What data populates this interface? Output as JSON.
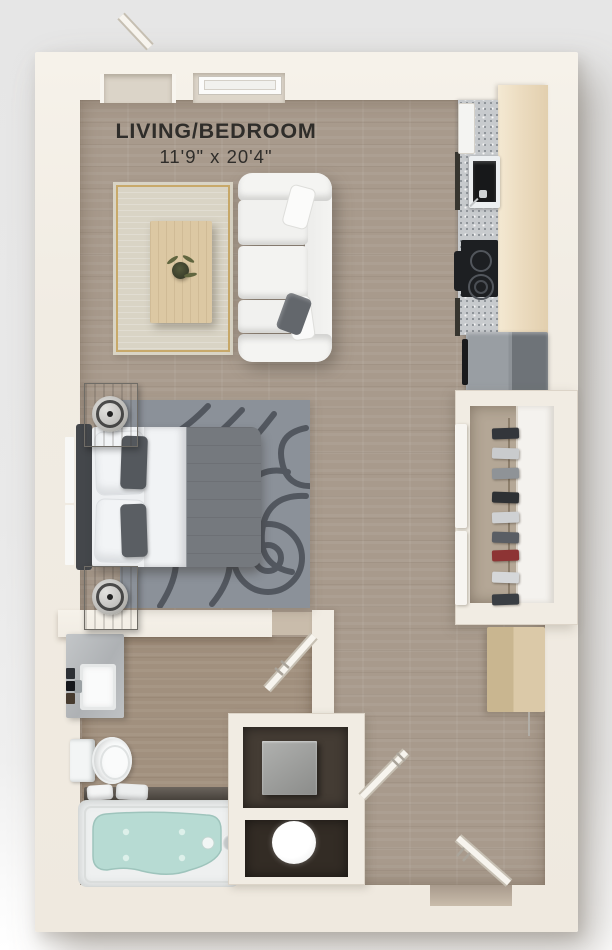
{
  "labels": {
    "room": "LIVING/BEDROOM",
    "dimensions": "11'9\" x 20'4\""
  },
  "palette": {
    "background": "#e9e9e9",
    "wall": "#f1ece3",
    "floor_wood": "#a89a8c",
    "floor_bath": "#a1907e",
    "floor_dark": "#332c25",
    "rug_living": "#d9d4c5",
    "rug_living_border": "#c8a96a",
    "rug_bed": "#8b9199",
    "rug_bed_pattern": "#494e55",
    "sofa_white": "#f4f4f2",
    "bed_duvet": "#75797e",
    "counter_granite": "#c7cacd",
    "cabinet_tan": "#ecdcc0",
    "fridge_gray": "#8d9297",
    "cooktop_black": "#1d1f22",
    "tub_water": "#b7dbd3",
    "wood_light": "#dcc8a3",
    "door_leaf": "#f7f4ee",
    "text": "#2f2d2a"
  },
  "features": {
    "rooms": [
      "living-bedroom",
      "kitchen",
      "closet",
      "bathroom",
      "utility-closets",
      "entry"
    ],
    "fixtures": [
      "sofa",
      "coffee-table",
      "plant",
      "bed",
      "nightstands",
      "lamps",
      "area-rugs",
      "kitchen-sink",
      "cooktop",
      "refrigerator",
      "counter",
      "upper-cabinets",
      "hanging-clothes",
      "desk",
      "vanity-sink",
      "toilet",
      "bathtub",
      "towels",
      "washer",
      "dryer-cabinet",
      "window",
      "doors"
    ]
  },
  "closet_items": [
    {
      "y": 428,
      "color": "#33363b"
    },
    {
      "y": 448,
      "color": "#c9cbcd"
    },
    {
      "y": 468,
      "color": "#8f9397"
    },
    {
      "y": 492,
      "color": "#2e3134"
    },
    {
      "y": 512,
      "color": "#cfd1d3"
    },
    {
      "y": 532,
      "color": "#5a5e64"
    },
    {
      "y": 550,
      "color": "#8d3434"
    },
    {
      "y": 572,
      "color": "#d5d7d9"
    },
    {
      "y": 594,
      "color": "#3a3e43"
    }
  ]
}
